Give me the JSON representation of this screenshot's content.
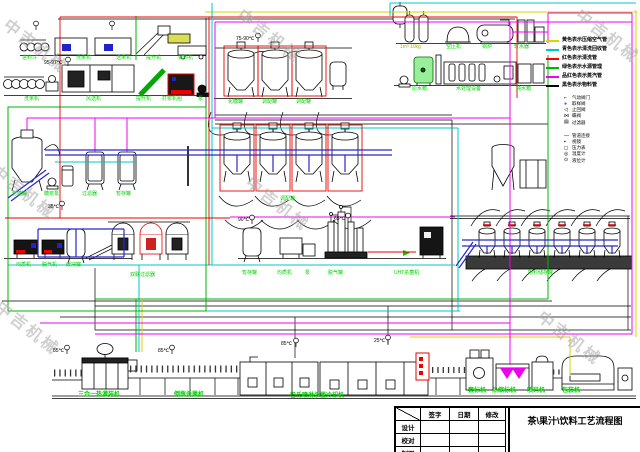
{
  "watermark": {
    "text": "中吉机械"
  },
  "title_block": {
    "title": "茶\\果汁\\饮料工艺流程图",
    "sign_col": "签字",
    "date_col": "日期",
    "rev_col": "修改",
    "rows": [
      "设计",
      "校对",
      "制图"
    ]
  },
  "pipe_legend": {
    "entries": [
      {
        "color": "#d6d600",
        "label": "黄色表示压缩空气管"
      },
      {
        "color": "#00c8c8",
        "label": "青色表示清洗回收管"
      },
      {
        "color": "#ff0000",
        "label": "红色表示清洗管"
      },
      {
        "color": "#00b400",
        "label": "绿色表示水源管理"
      },
      {
        "color": "#f000f0",
        "label": "品红色表示蒸汽管"
      },
      {
        "color": "#000000",
        "label": "黑色表示物料管"
      }
    ]
  },
  "symbol_legend": {
    "groups": [
      {
        "entries": [
          {
            "glyph": "⌐",
            "color": "#000000",
            "label": "气动阀门"
          },
          {
            "glyph": "●",
            "color": "#e000e0",
            "label": "取样阀"
          },
          {
            "glyph": "◁",
            "color": "#000000",
            "label": "止回阀"
          },
          {
            "glyph": "⋈",
            "color": "#000000",
            "label": "蝶阀"
          },
          {
            "glyph": "▤",
            "color": "#000000",
            "label": "过滤器"
          }
        ]
      },
      {
        "entries": [
          {
            "glyph": "—",
            "color": "#000000",
            "label": "管道连接"
          },
          {
            "glyph": "▪",
            "color": "#000000",
            "label": "视镜"
          },
          {
            "glyph": "◻",
            "color": "#000000",
            "label": "压力表"
          },
          {
            "glyph": "◎",
            "color": "#000000",
            "label": "温度计"
          },
          {
            "glyph": "⊙",
            "color": "#000000",
            "label": "液位计"
          }
        ]
      }
    ]
  },
  "equipment_labels": [
    {
      "t": "进料斗",
      "x": 22,
      "y": 56,
      "cls": "g"
    },
    {
      "t": "洗果机",
      "x": 76,
      "y": 56,
      "cls": "g"
    },
    {
      "t": "选果机",
      "x": 116,
      "y": 56,
      "cls": "g"
    },
    {
      "t": "提升机",
      "x": 146,
      "y": 56,
      "cls": "g"
    },
    {
      "t": "输料机",
      "x": 178,
      "y": 56,
      "cls": "g"
    },
    {
      "t": "洗果机",
      "x": 24,
      "y": 97,
      "cls": "g"
    },
    {
      "t": "风选机",
      "x": 86,
      "y": 97,
      "cls": "g"
    },
    {
      "t": "提升机",
      "x": 136,
      "y": 97,
      "cls": "g"
    },
    {
      "t": "打浆机组",
      "x": 162,
      "y": 97,
      "cls": "g"
    },
    {
      "t": "泵",
      "x": 198,
      "y": 97,
      "cls": "g"
    },
    {
      "t": "化糖罐",
      "x": 228,
      "y": 100,
      "cls": "g"
    },
    {
      "t": "调配罐",
      "x": 262,
      "y": 100,
      "cls": "g"
    },
    {
      "t": "调配罐",
      "x": 296,
      "y": 100,
      "cls": "g"
    },
    {
      "t": "1m³ 10kg",
      "x": 400,
      "y": 45,
      "cls": "g",
      "c": "#b0b000"
    },
    {
      "t": "空压机",
      "x": 446,
      "y": 45,
      "cls": "g"
    },
    {
      "t": "锅炉",
      "x": 482,
      "y": 45,
      "cls": "g"
    },
    {
      "t": "软水器",
      "x": 514,
      "y": 45,
      "cls": "g"
    },
    {
      "t": "原水箱",
      "x": 412,
      "y": 87,
      "cls": "g"
    },
    {
      "t": "水处理设备",
      "x": 456,
      "y": 87,
      "cls": "g"
    },
    {
      "t": "纯水箱",
      "x": 516,
      "y": 87,
      "cls": "g"
    },
    {
      "t": "化糖罐",
      "x": 12,
      "y": 192,
      "cls": "g"
    },
    {
      "t": "糖浆泵",
      "x": 44,
      "y": 192,
      "cls": "g"
    },
    {
      "t": "过滤器",
      "x": 82,
      "y": 192,
      "cls": "g"
    },
    {
      "t": "暂存罐",
      "x": 116,
      "y": 192,
      "cls": "g"
    },
    {
      "t": "调配罐",
      "x": 280,
      "y": 197,
      "cls": "g"
    },
    {
      "t": "均质机",
      "x": 16,
      "y": 263,
      "cls": "g"
    },
    {
      "t": "脱气机",
      "x": 42,
      "y": 263,
      "cls": "g"
    },
    {
      "t": "缓冲罐",
      "x": 66,
      "y": 263,
      "cls": "g"
    },
    {
      "t": "双联过滤器",
      "x": 130,
      "y": 273,
      "cls": "g"
    },
    {
      "t": "暂存罐",
      "x": 242,
      "y": 271,
      "cls": "g"
    },
    {
      "t": "均质机",
      "x": 277,
      "y": 271,
      "cls": "g"
    },
    {
      "t": "泵",
      "x": 305,
      "y": 271,
      "cls": "g"
    },
    {
      "t": "脱气罐",
      "x": 328,
      "y": 271,
      "cls": "g"
    },
    {
      "t": "UHT杀菌机",
      "x": 394,
      "y": 271,
      "cls": "g"
    },
    {
      "t": "物料储存罐",
      "x": 528,
      "y": 271,
      "cls": "g"
    },
    {
      "t": "三合一热灌装机",
      "x": 78,
      "y": 392,
      "cls": "gb"
    },
    {
      "t": "倒瓶杀菌机",
      "x": 174,
      "y": 392,
      "cls": "gb"
    },
    {
      "t": "巴氏喷淋杀菌冷却机",
      "x": 290,
      "y": 393,
      "cls": "gb"
    },
    {
      "t": "套标机",
      "x": 468,
      "y": 388,
      "cls": "gb"
    },
    {
      "t": "热缩标机",
      "x": 492,
      "y": 388,
      "cls": "gb"
    },
    {
      "t": "喷码机",
      "x": 527,
      "y": 388,
      "cls": "gb"
    },
    {
      "t": "包装机",
      "x": 562,
      "y": 388,
      "cls": "gb"
    },
    {
      "t": "95-97℃",
      "x": 44,
      "y": 61,
      "cls": "k"
    },
    {
      "t": "75-90℃",
      "x": 236,
      "y": 37,
      "cls": "k"
    },
    {
      "t": "90℃",
      "x": 238,
      "y": 218,
      "cls": "k"
    },
    {
      "t": "65℃",
      "x": 334,
      "y": 217,
      "cls": "k"
    },
    {
      "t": "35℃",
      "x": 48,
      "y": 205,
      "cls": "k"
    },
    {
      "t": "85℃",
      "x": 53,
      "y": 349,
      "cls": "k"
    },
    {
      "t": "85℃",
      "x": 158,
      "y": 349,
      "cls": "k"
    },
    {
      "t": "85℃",
      "x": 281,
      "y": 342,
      "cls": "k"
    },
    {
      "t": "25℃",
      "x": 374,
      "y": 339,
      "cls": "k"
    }
  ]
}
